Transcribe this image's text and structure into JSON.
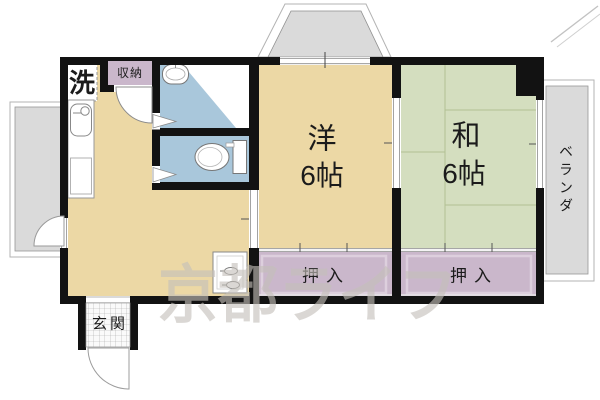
{
  "floorplan": {
    "watermark": "京都ライフ",
    "labels": {
      "laundry": "洗",
      "storage": "収納",
      "western_name": "洋",
      "western_size": "6帖",
      "japanese_name": "和",
      "japanese_size": "6帖",
      "closet_west": "押入",
      "closet_east": "押入",
      "entrance": "玄関",
      "veranda": "ベランダ"
    },
    "colors": {
      "wood_floor": "#ecd8a5",
      "tatami_floor": "#d4debf",
      "closet_fill": "#cab7cb",
      "wet_area_fill": "#a9c7db",
      "balcony_fill": "#dadada",
      "wall": "#121212",
      "watermark_gray": "#c5c0ba"
    }
  }
}
